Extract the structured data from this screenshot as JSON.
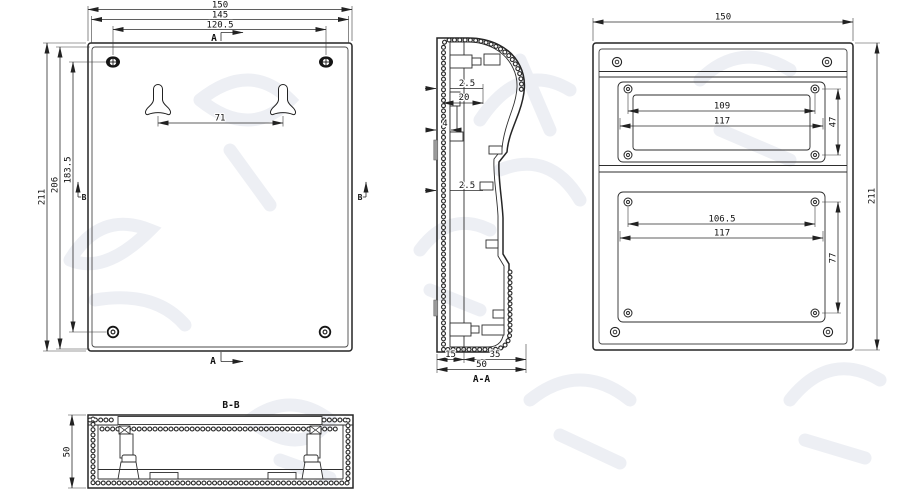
{
  "title": "enclosure-technical-drawing",
  "colors": {
    "line": "#252525",
    "dimension": "#2a2a2a",
    "background": "#ffffff",
    "watermark": "#edeff4",
    "seal_clip": "#9a9a9a"
  },
  "views": {
    "back": {
      "name": "back-view",
      "dim_overall_width": "150",
      "dim_lid_width": "145",
      "dim_screw_span_h": "120.5",
      "dim_keyhole_span": "71",
      "dim_overall_height": "211",
      "dim_lid_height": "206",
      "dim_screw_span_v": "183.5",
      "section_marker_a": "A",
      "section_marker_b": "B"
    },
    "section_aa": {
      "label": "A-A",
      "dim_wall_upper": "2.5",
      "dim_boss_depth": "20",
      "dim_rib": "4",
      "dim_wall_lower": "2.5",
      "dim_base_depth": "15",
      "dim_cover_depth": "35",
      "dim_total_depth": "50"
    },
    "front": {
      "name": "front-view",
      "dim_overall_width": "150",
      "dim_overall_height": "211",
      "upper_cutout": {
        "dim_screw_span": "109",
        "dim_width": "117",
        "dim_height": "47"
      },
      "lower_cutout": {
        "dim_screw_span": "106.5",
        "dim_width": "117",
        "dim_height": "77"
      }
    },
    "section_bb": {
      "label": "B-B",
      "dim_depth": "50"
    }
  }
}
